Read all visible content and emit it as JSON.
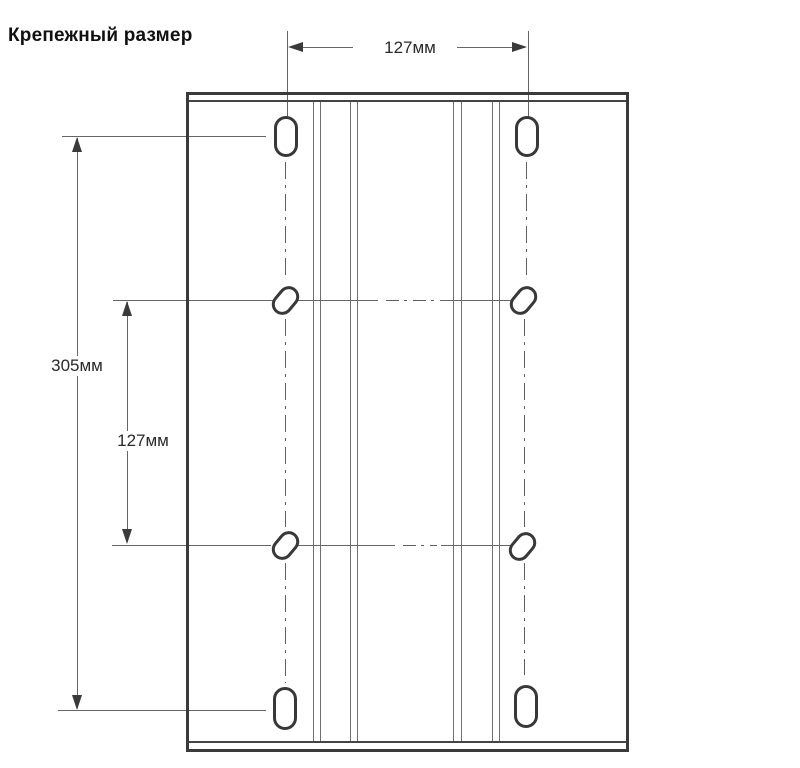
{
  "title": "Крепежный размер",
  "dimensions": {
    "top_width": "127мм",
    "left_total_height": "305мм",
    "left_hole_spacing": "127мм"
  },
  "colors": {
    "object_line": "#3a3a3a",
    "thin_line": "#666666",
    "text": "#1c1c1c",
    "background": "#ffffff"
  }
}
